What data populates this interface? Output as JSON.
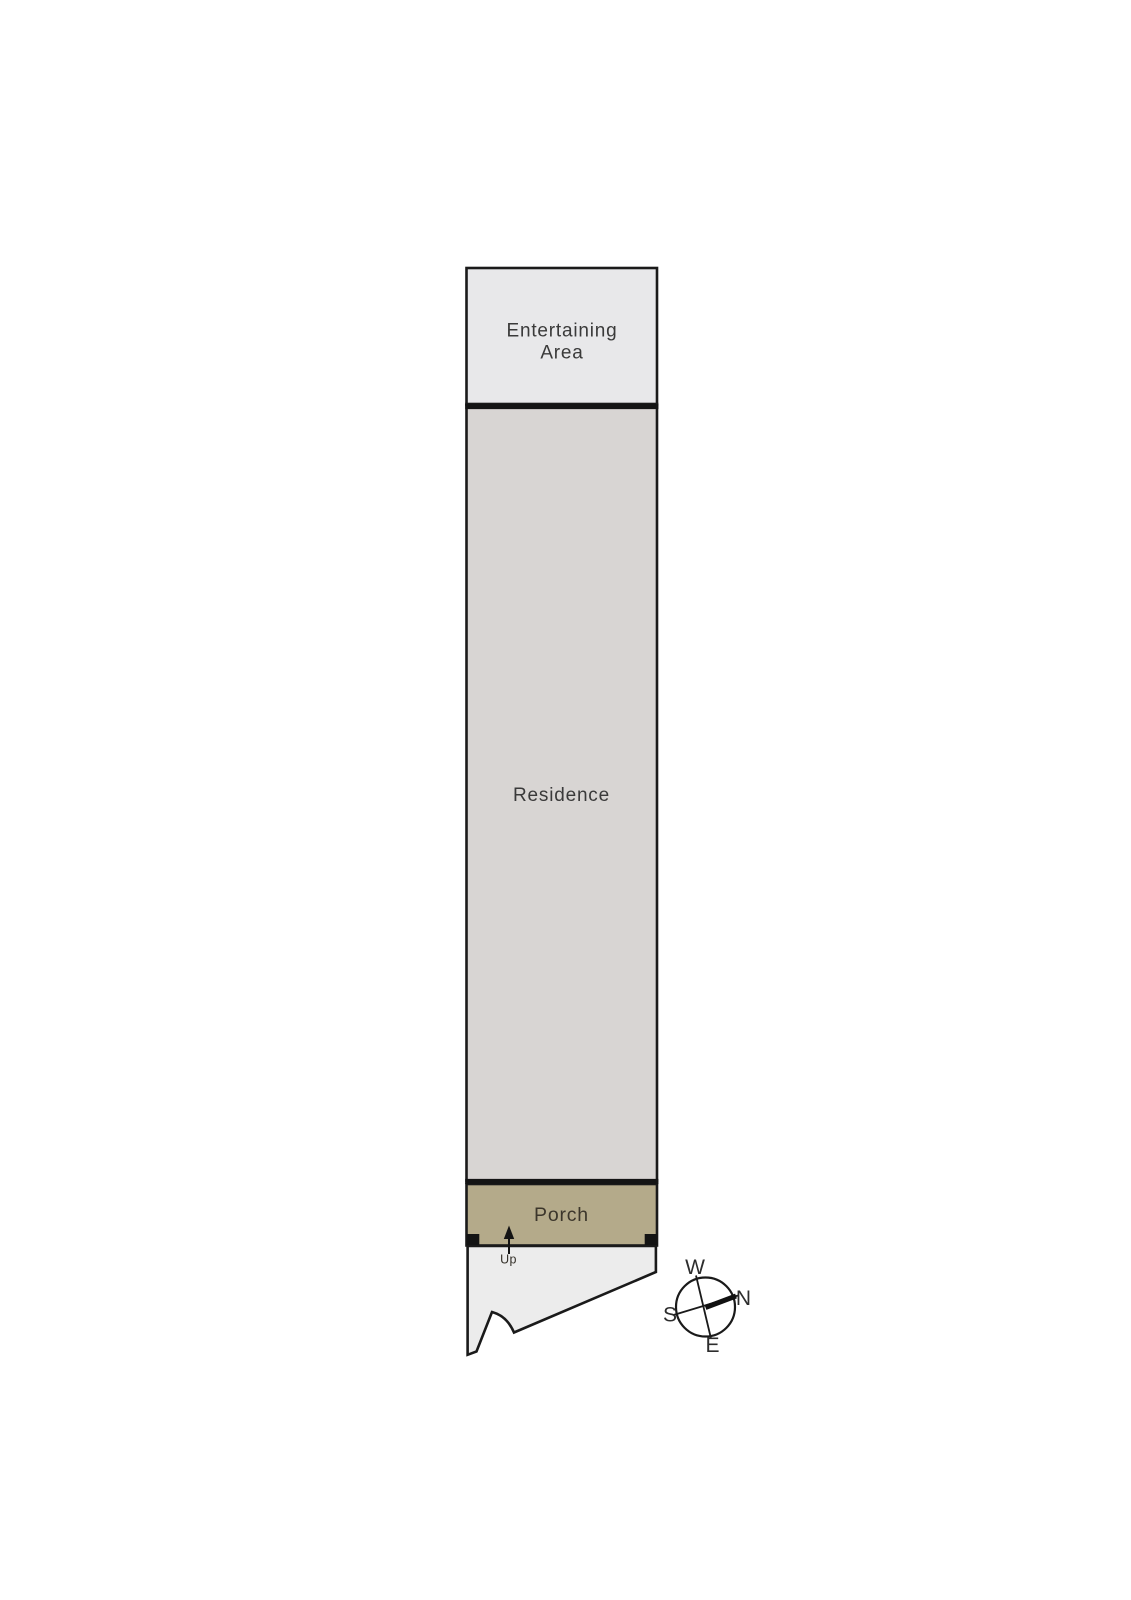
{
  "floorplan": {
    "rooms": [
      {
        "name": "Entertaining Area",
        "line1": "Entertaining",
        "line2": "Area",
        "fill": "#e8e8ea"
      },
      {
        "name": "Residence",
        "fill": "#d8d5d3"
      },
      {
        "name": "Porch",
        "fill": "#b4aa8a"
      }
    ],
    "land": {
      "fill": "#ececec"
    },
    "stair_label": "Up",
    "outline_color": "#1a1a1a",
    "divider_color": "#141414",
    "label_color": "#3a3a3a"
  },
  "compass": {
    "west": "W",
    "north": "N",
    "south": "S",
    "east": "E",
    "needle_color": "#111111"
  }
}
